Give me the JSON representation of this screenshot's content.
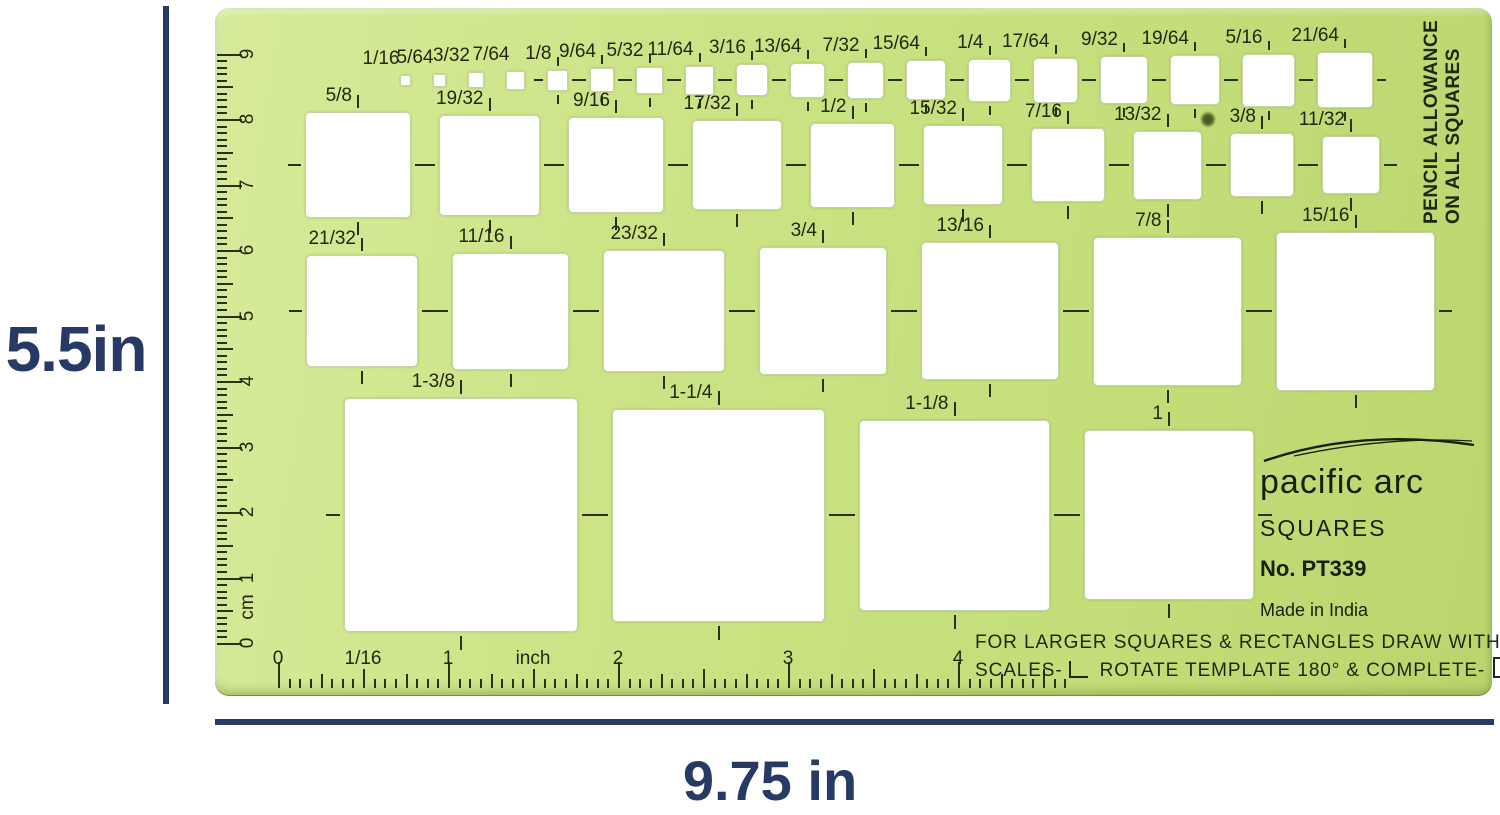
{
  "product": {
    "dimension_height_label": "5.5in",
    "dimension_width_label": "9.75 in"
  },
  "template": {
    "corner_note_lines": [
      "PENCIL ALLOWANCE",
      "ON ALL SQUARES"
    ],
    "brand": {
      "name": "pacific arc",
      "series": "SQUARES",
      "model": "No. PT339",
      "origin": "Made in India"
    },
    "usage_note": {
      "line1": "FOR LARGER SQUARES & RECTANGLES DRAW WITH EDGE",
      "line2_part1": "SCALES-",
      "line2_part2": "ROTATE TEMPLATE 180° & COMPLETE-"
    },
    "rows": [
      {
        "name": "sixty-fourths-row",
        "squares": [
          {
            "label": "1/16",
            "size_in": 0.0625
          },
          {
            "label": "5/64",
            "size_in": 0.078125
          },
          {
            "label": "3/32",
            "size_in": 0.09375
          },
          {
            "label": "7/64",
            "size_in": 0.109375
          },
          {
            "label": "1/8",
            "size_in": 0.125
          },
          {
            "label": "9/64",
            "size_in": 0.140625
          },
          {
            "label": "5/32",
            "size_in": 0.15625
          },
          {
            "label": "11/64",
            "size_in": 0.171875
          },
          {
            "label": "3/16",
            "size_in": 0.1875
          },
          {
            "label": "13/64",
            "size_in": 0.203125
          },
          {
            "label": "7/32",
            "size_in": 0.21875
          },
          {
            "label": "15/64",
            "size_in": 0.234375
          },
          {
            "label": "1/4",
            "size_in": 0.25
          },
          {
            "label": "17/64",
            "size_in": 0.265625
          },
          {
            "label": "9/32",
            "size_in": 0.28125
          },
          {
            "label": "19/64",
            "size_in": 0.296875
          },
          {
            "label": "5/16",
            "size_in": 0.3125
          },
          {
            "label": "21/64",
            "size_in": 0.328125
          }
        ]
      },
      {
        "name": "half-inch-row",
        "squares": [
          {
            "label": "5/8",
            "size_in": 0.625
          },
          {
            "label": "19/32",
            "size_in": 0.59375
          },
          {
            "label": "9/16",
            "size_in": 0.5625
          },
          {
            "label": "17/32",
            "size_in": 0.53125
          },
          {
            "label": "1/2",
            "size_in": 0.5
          },
          {
            "label": "15/32",
            "size_in": 0.46875
          },
          {
            "label": "7/16",
            "size_in": 0.4375
          },
          {
            "label": "13/32",
            "size_in": 0.40625
          },
          {
            "label": "3/8",
            "size_in": 0.375
          },
          {
            "label": "11/32",
            "size_in": 0.34375
          }
        ]
      },
      {
        "name": "three-quarter-row",
        "squares": [
          {
            "label": "21/32",
            "size_in": 0.65625
          },
          {
            "label": "11/16",
            "size_in": 0.6875
          },
          {
            "label": "23/32",
            "size_in": 0.71875
          },
          {
            "label": "3/4",
            "size_in": 0.75
          },
          {
            "label": "13/16",
            "size_in": 0.8125
          },
          {
            "label": "7/8",
            "size_in": 0.875
          },
          {
            "label": "15/16",
            "size_in": 0.9375
          }
        ]
      },
      {
        "name": "inch-plus-row",
        "squares": [
          {
            "label": "1-3/8",
            "size_in": 1.375
          },
          {
            "label": "1-1/4",
            "size_in": 1.25
          },
          {
            "label": "1-1/8",
            "size_in": 1.125
          },
          {
            "label": "1",
            "size_in": 1.0
          }
        ]
      }
    ],
    "cm_ruler": {
      "numbers": [
        "0",
        "1",
        "2",
        "3",
        "4",
        "5",
        "6",
        "7",
        "8",
        "9"
      ],
      "unit_label": "cm"
    },
    "inch_ruler": {
      "numbers": [
        "0",
        "1",
        "2",
        "3",
        "4"
      ],
      "graduation_label": "1/16",
      "unit_label": "inch"
    }
  },
  "colors": {
    "accent_navy": "#273a66",
    "template_green": "#c4de7a",
    "ink": "#23290f"
  }
}
